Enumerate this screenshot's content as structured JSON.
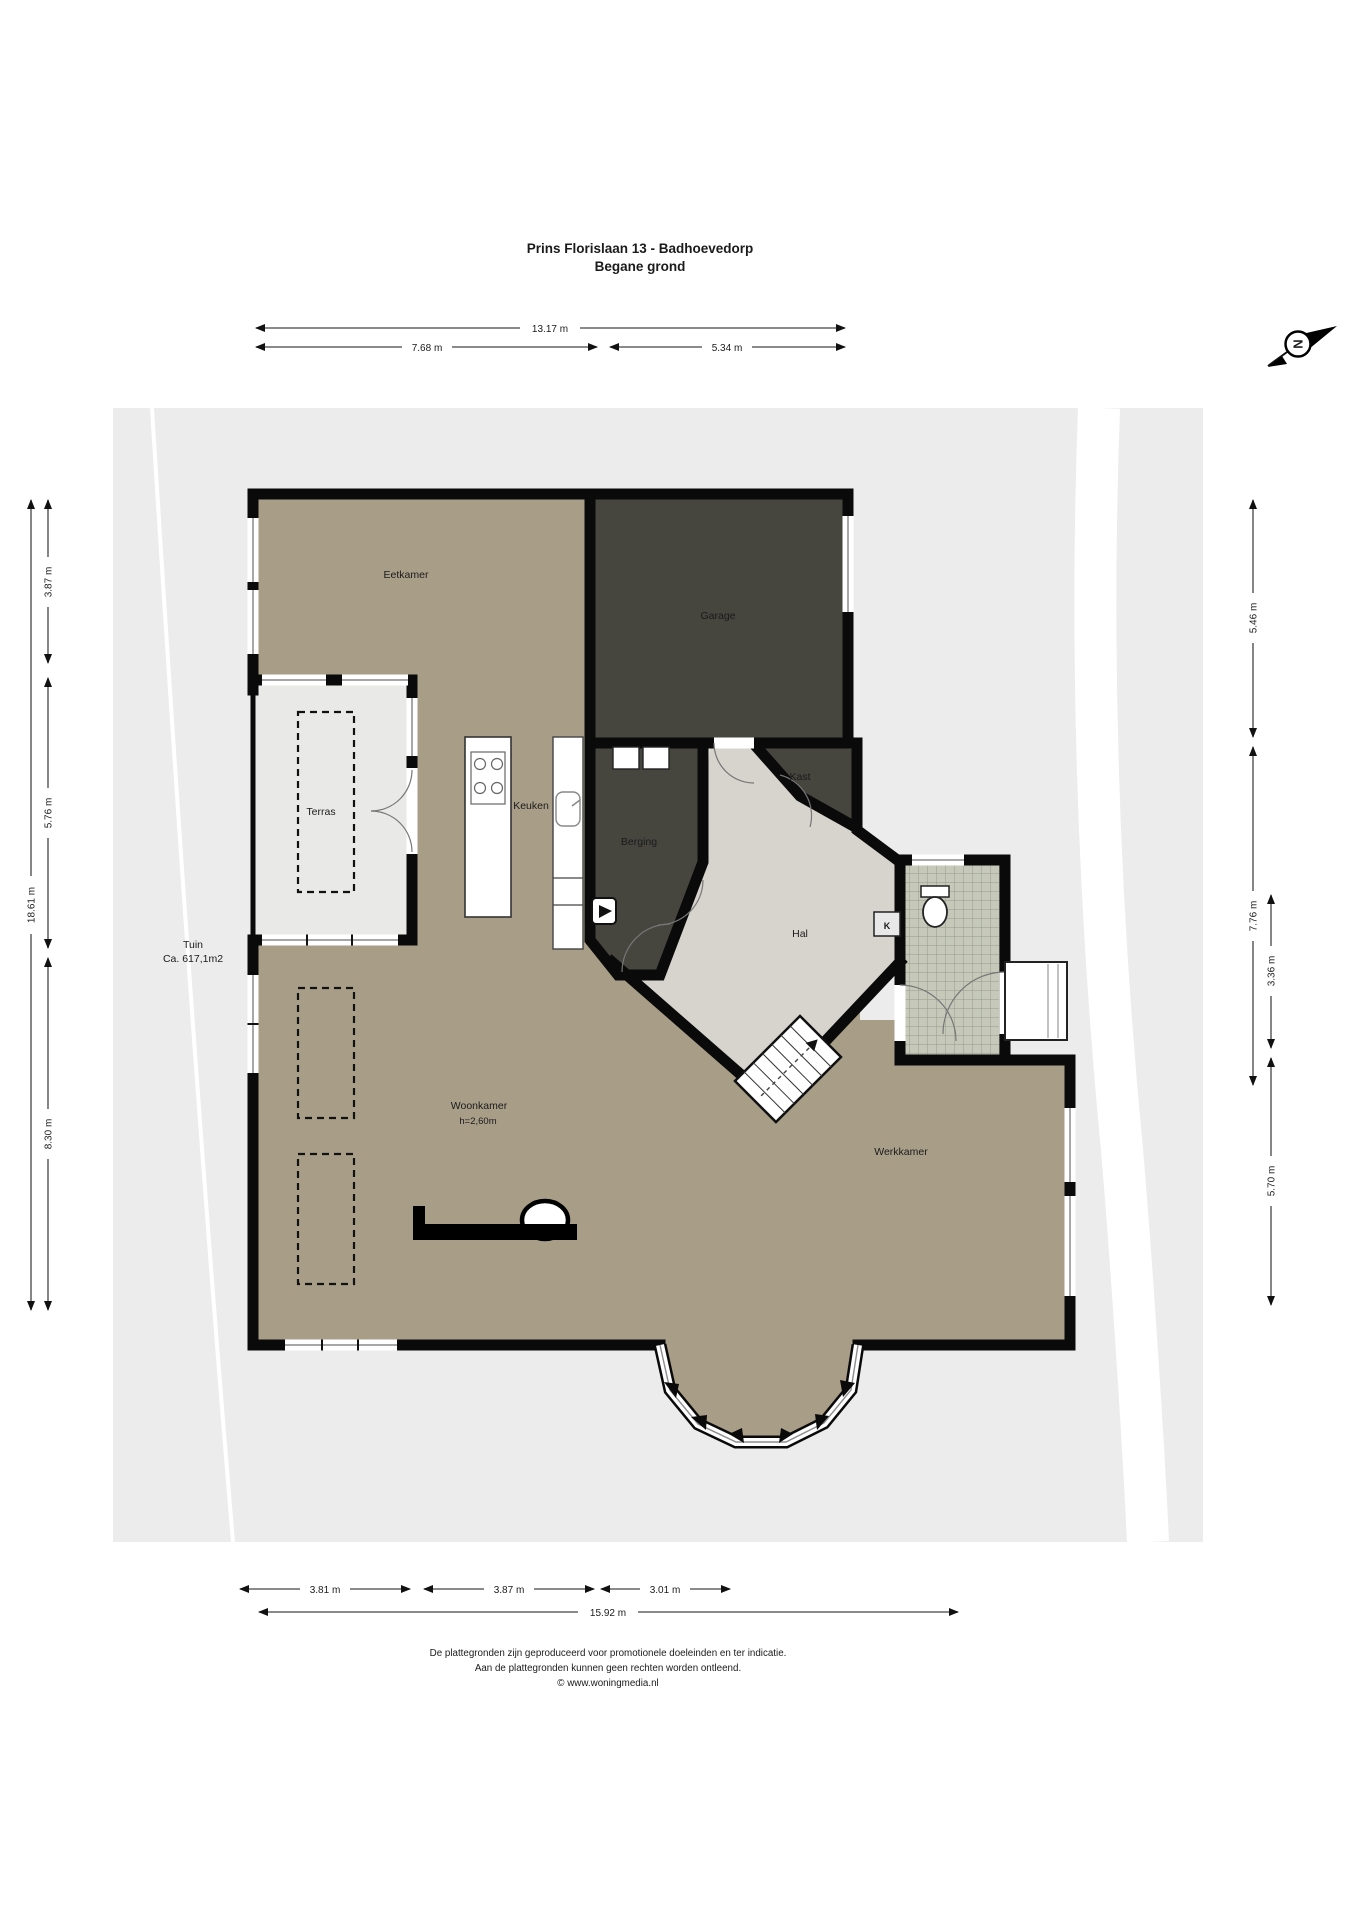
{
  "page": {
    "title_line1": "Prins Florislaan 13 - Badhoevedorp",
    "title_line2": "Begane grond"
  },
  "compass": {
    "north_letter": "N"
  },
  "rooms": {
    "eetkamer": "Eetkamer",
    "garage": "Garage",
    "terras": "Terras",
    "keuken": "Keuken",
    "berging": "Berging",
    "kast": "Kast",
    "hal": "Hal",
    "woonkamer": "Woonkamer",
    "woonkamer_height": "h=2,60m",
    "werkkamer": "Werkkamer",
    "tuin": "Tuin",
    "tuin_area": "Ca. 617,1m2",
    "meterkast": "K"
  },
  "dimensions": {
    "top": {
      "total": "13.17 m",
      "left": "7.68 m",
      "right": "5.34 m"
    },
    "left": {
      "total": "18.61 m",
      "top": "3.87 m",
      "middle": "5.76 m",
      "bottom": "8.30 m"
    },
    "right": {
      "top": "5.46 m",
      "middle": "7.76 m",
      "inner_top": "3.36 m",
      "inner_bottom": "5.70 m"
    },
    "bottom": {
      "seg1": "3.81 m",
      "seg2": "3.87 m",
      "seg3": "3.01 m",
      "total": "15.92 m"
    }
  },
  "footer": {
    "line1": "De plattegronden zijn geproduceerd voor promotionele doeleinden en ter indicatie.",
    "line2": "Aan de plattegronden kunnen geen rechten worden ontleend.",
    "line3": "© www.woningmedia.nl"
  },
  "colors": {
    "wall": "#0a0a0a",
    "floor_beige": "#a89e88",
    "dark_room": "#46453e",
    "terrace": "#e9e9e7",
    "hall": "#d6d4cc",
    "parcel": "#ececec",
    "tile": "#c6c8ba"
  }
}
